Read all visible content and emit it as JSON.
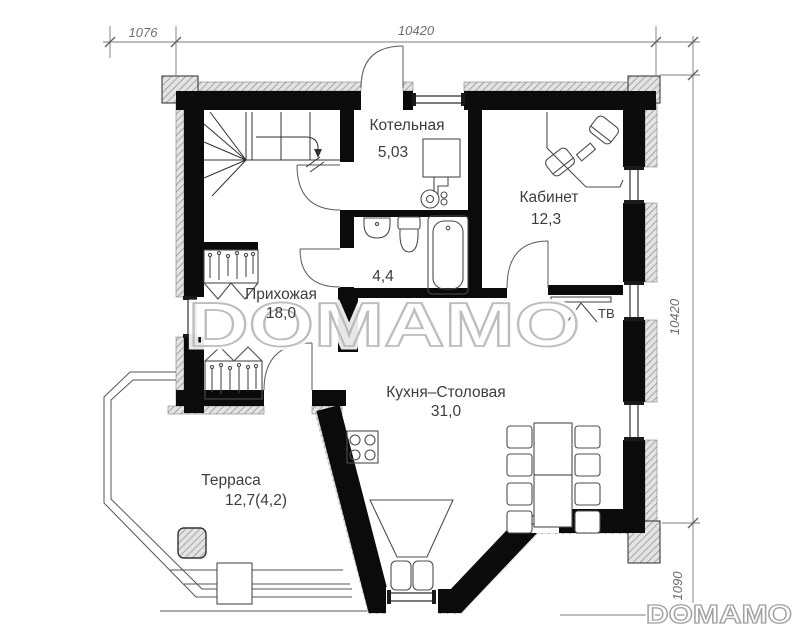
{
  "watermark": {
    "center_text": "DOMAMO",
    "corner_text": "DOMAMO"
  },
  "dimensions": {
    "top_secondary": "1076",
    "top_main": "10420",
    "right_main": "10420",
    "right_secondary": "1090"
  },
  "rooms": {
    "boiler": {
      "name": "Котельная",
      "area": "5,03"
    },
    "office": {
      "name": "Кабинет",
      "area": "12,3"
    },
    "hallway": {
      "name": "Прихожая",
      "area": "18,0"
    },
    "bathroom": {
      "area": "4,4"
    },
    "kitchen": {
      "name": "Кухня–Столовая",
      "area": "31,0"
    },
    "terrace": {
      "name": "Терраса",
      "area": "12,7(4,2)"
    }
  },
  "labels": {
    "tv": "ТВ"
  }
}
